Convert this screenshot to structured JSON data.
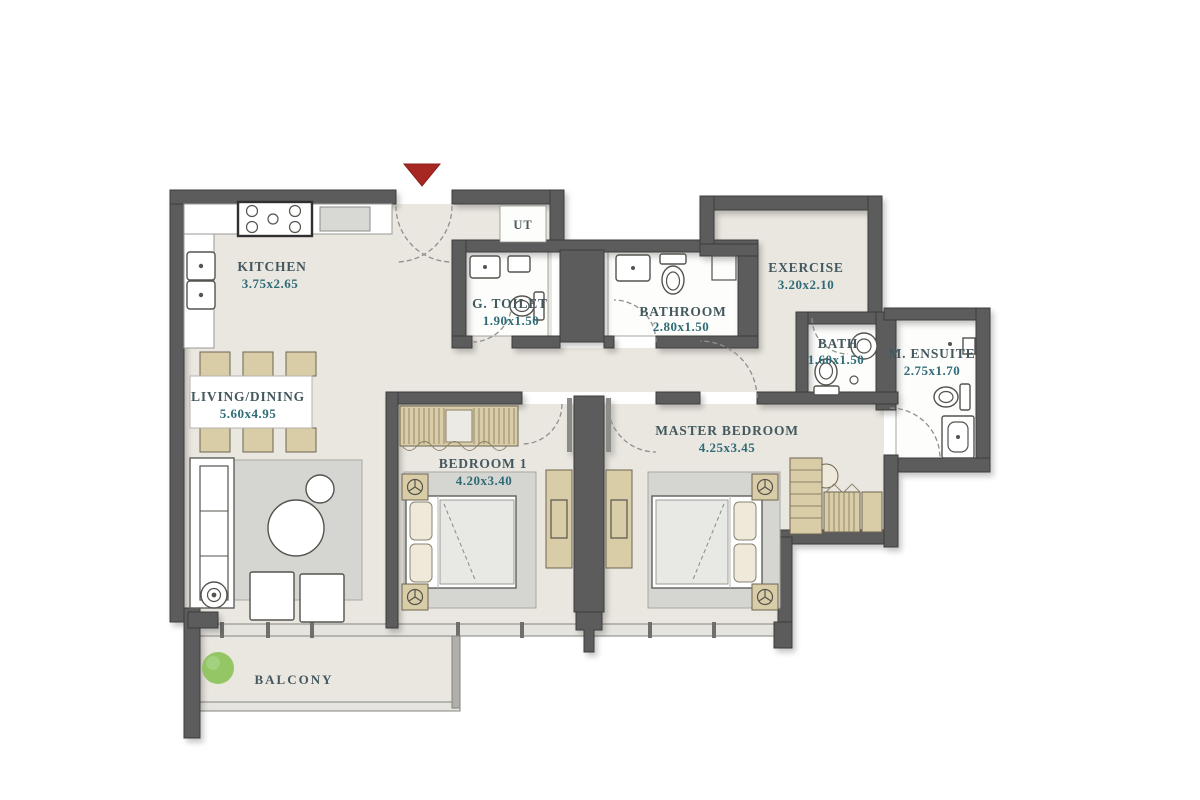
{
  "plan": {
    "type": "apartment-floor-plan",
    "entry": {
      "marker": "entry-arrow",
      "direction": "down"
    },
    "rooms": [
      {
        "id": "kitchen",
        "name": "KITCHEN",
        "dims": "3.75x2.65"
      },
      {
        "id": "living-dining",
        "name": "LIVING/DINING",
        "dims": "5.60x4.95"
      },
      {
        "id": "g-toilet",
        "name": "G. TOILET",
        "dims": "1.90x1.50"
      },
      {
        "id": "bathroom",
        "name": "BATHROOM",
        "dims": "2.80x1.50"
      },
      {
        "id": "exercise",
        "name": "EXERCISE",
        "dims": "3.20x2.10"
      },
      {
        "id": "bath",
        "name": "BATH",
        "dims": "1.60x1.50"
      },
      {
        "id": "m-ensuite",
        "name": "M. ENSUITE",
        "dims": "2.75x1.70"
      },
      {
        "id": "master-bedroom",
        "name": "MASTER BEDROOM",
        "dims": "4.25x3.45"
      },
      {
        "id": "bedroom-1",
        "name": "BEDROOM 1",
        "dims": "4.20x3.40"
      },
      {
        "id": "balcony",
        "name": "BALCONY"
      },
      {
        "id": "utility",
        "name": "UT"
      }
    ],
    "colors": {
      "wall": "#5b5b5b",
      "floor": "#eae7e0",
      "wet_floor": "#fdfdfb",
      "label": "#44585f",
      "dims": "#2e6b77",
      "entry_arrow": "#a72823",
      "plant": "#8bc258"
    }
  }
}
